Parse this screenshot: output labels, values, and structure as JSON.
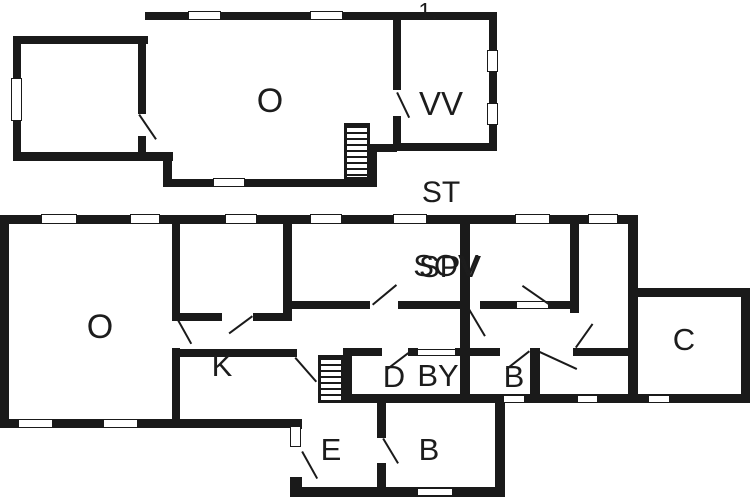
{
  "plan": {
    "title": "floor-plan",
    "floor1": {
      "floor_number": "1.",
      "rooms": {
        "o": "O",
        "vv": "VV"
      }
    },
    "ground": {
      "section_label": "ST",
      "rooms": {
        "o": "O",
        "k": "K",
        "sov": "SOV",
        "spv": "SPV",
        "d": "D",
        "by": "BY",
        "b_mid": "B",
        "c": "C",
        "e": "E",
        "b_low": "B"
      }
    },
    "colors": {
      "wall": "#1a1a1a",
      "background": "#ffffff",
      "label": "#1c1c1c"
    }
  }
}
